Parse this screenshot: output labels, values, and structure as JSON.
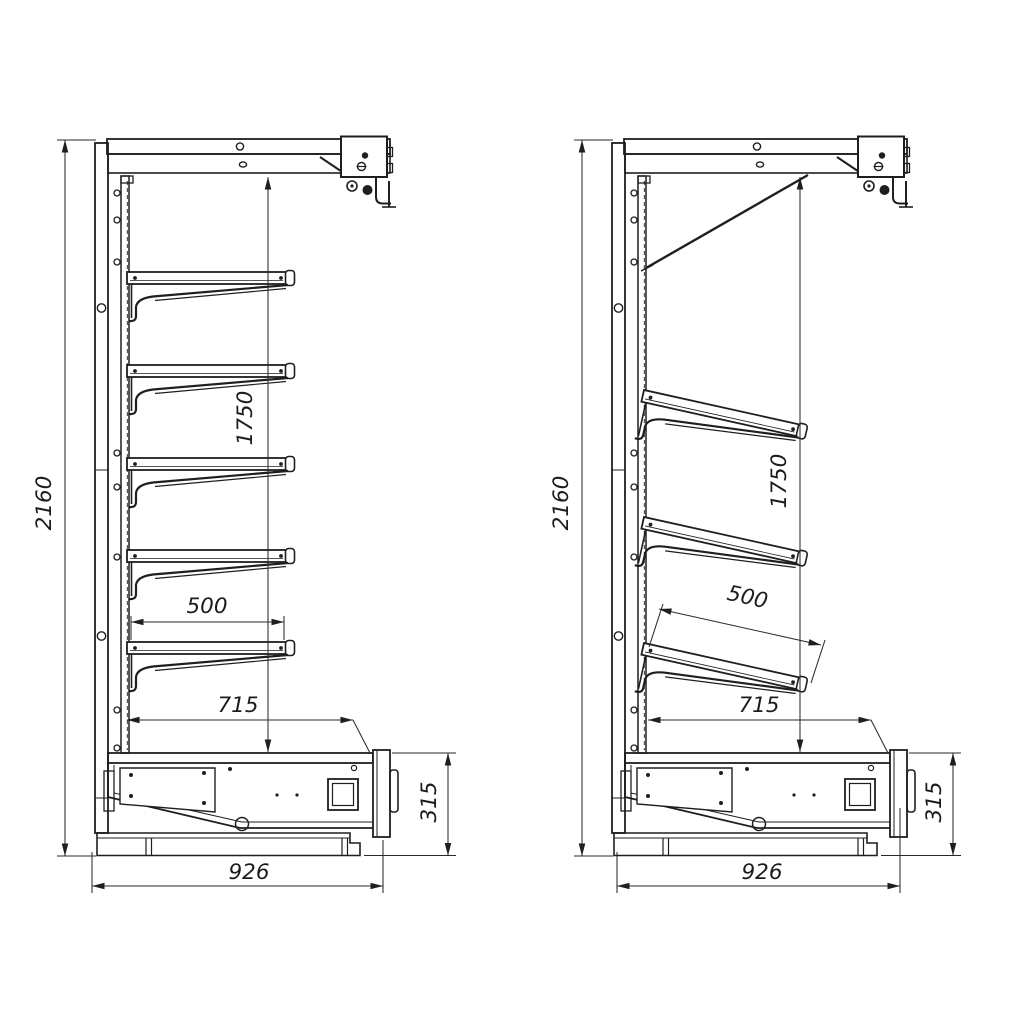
{
  "drawing": {
    "title": "Wall shelving / multideck unit — side elevation technical drawing",
    "background": "#ffffff",
    "line_color": "#1f1f1f"
  },
  "views": [
    {
      "id": "left",
      "name": "side-view-straight-shelves",
      "shelf_count": 5,
      "dims": {
        "overall_height": "2160",
        "display_height": "1750",
        "shelf_depth": "500",
        "well_depth": "715",
        "base_height": "315",
        "overall_depth": "926"
      }
    },
    {
      "id": "right",
      "name": "side-view-inclined-shelves",
      "shelf_count": 3,
      "dims": {
        "overall_height": "2160",
        "display_height": "1750",
        "shelf_depth": "500",
        "well_depth": "715",
        "base_height": "315",
        "overall_depth": "926"
      }
    }
  ]
}
